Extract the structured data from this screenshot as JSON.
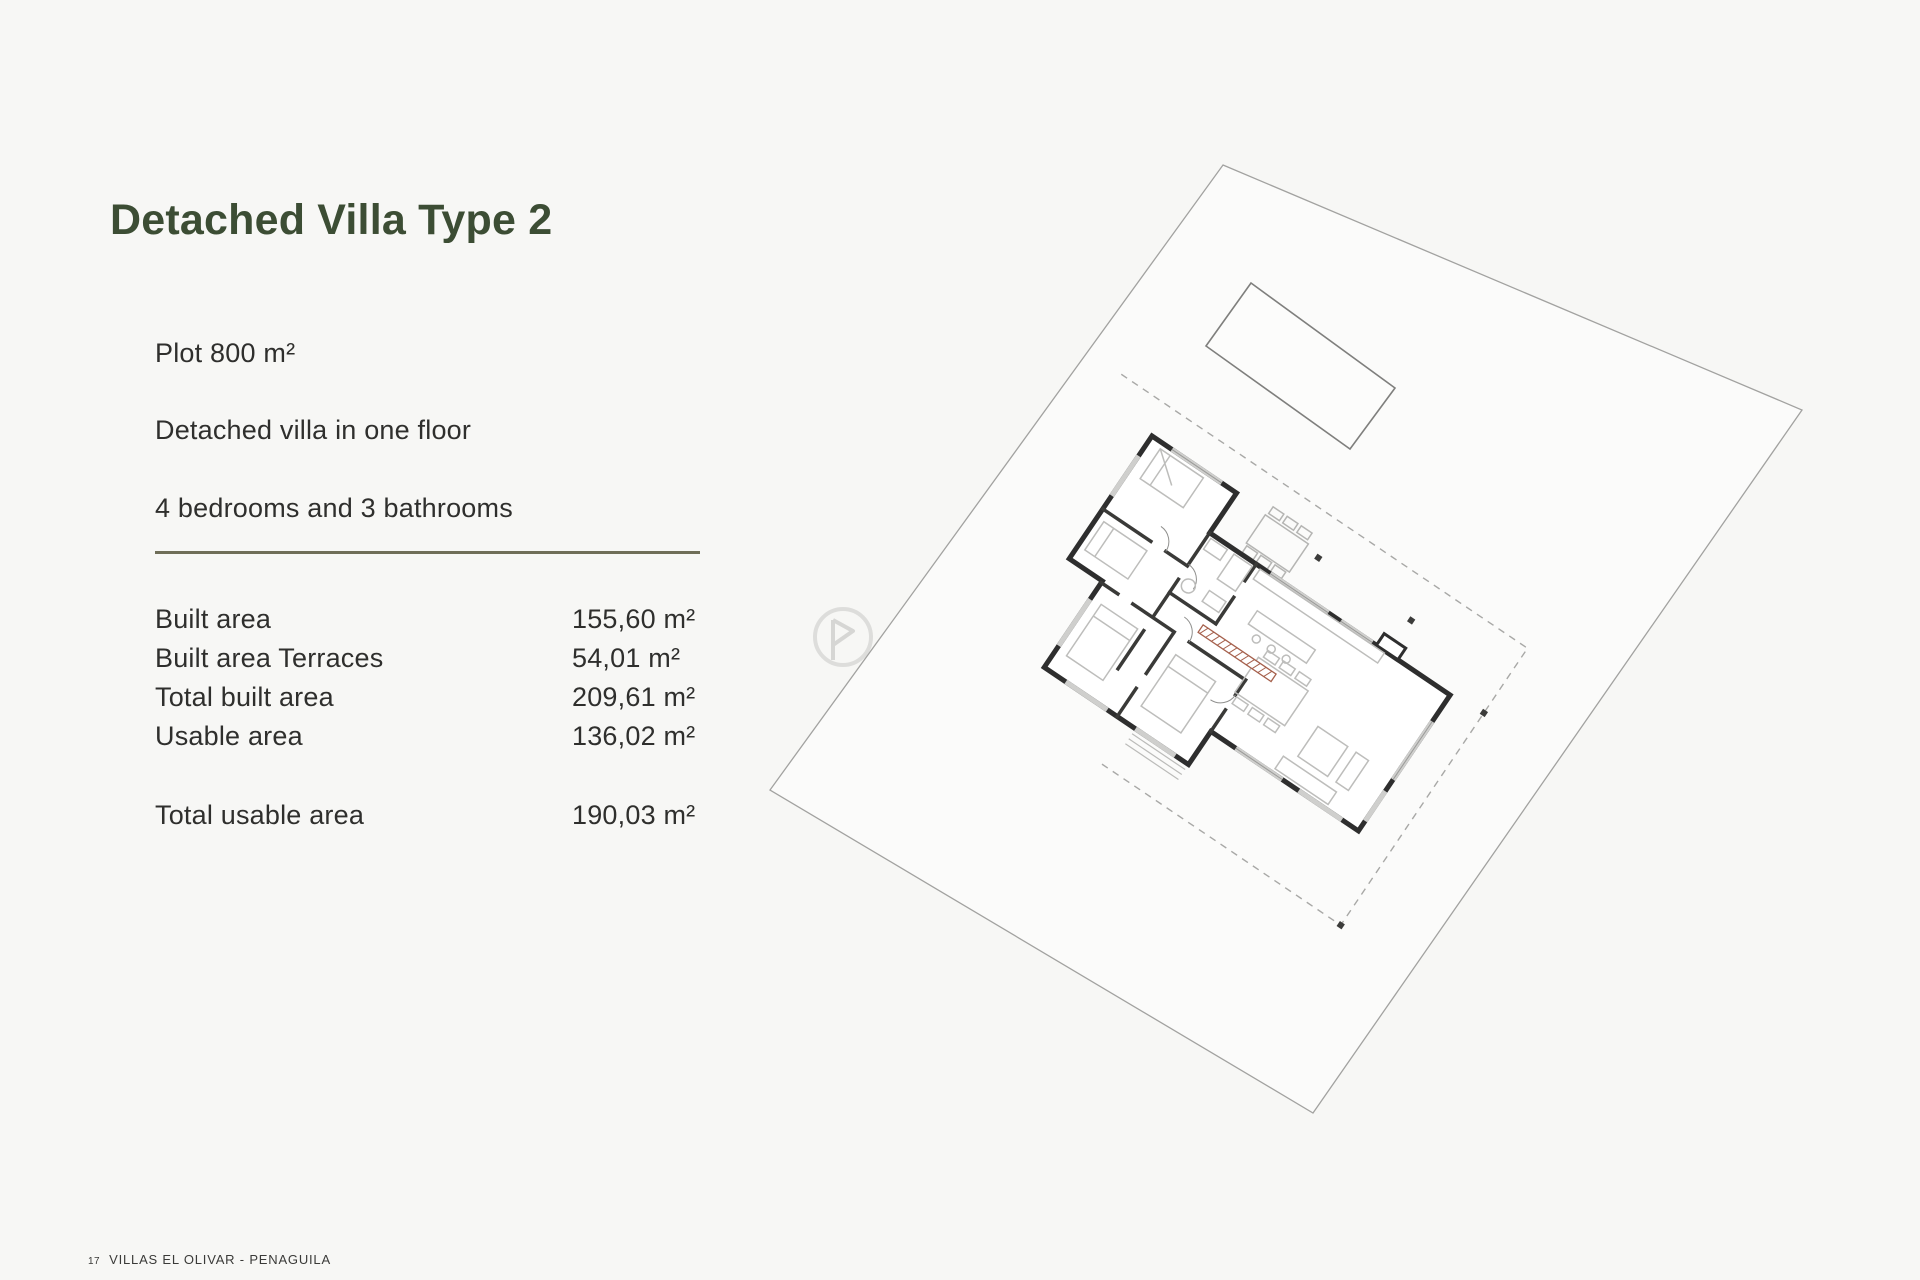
{
  "header": {
    "title": "Detached Villa Type 2"
  },
  "description": {
    "lines": [
      "Plot 800 m²",
      "Detached villa in one floor",
      "4 bedrooms and 3 bathrooms"
    ]
  },
  "areas": {
    "rows": [
      {
        "label": "Built area",
        "value": "155,60 m²"
      },
      {
        "label": "Built area Terraces",
        "value": "54,01 m²"
      },
      {
        "label": "Total built area",
        "value": "209,61 m²"
      },
      {
        "label": "Usable area",
        "value": "136,02 m²"
      }
    ],
    "total_row": {
      "label": "Total usable area",
      "value": "190,03 m²"
    }
  },
  "footer": {
    "page_number": "17",
    "project": "VILLAS EL OLIVAR - PENAGUILA"
  },
  "theme": {
    "title_color": "#3c4d34",
    "divider_color": "#6f6e58",
    "wall_color": "#2e2e2e",
    "accent_red": "#a5604c",
    "background": "#f7f7f5"
  }
}
